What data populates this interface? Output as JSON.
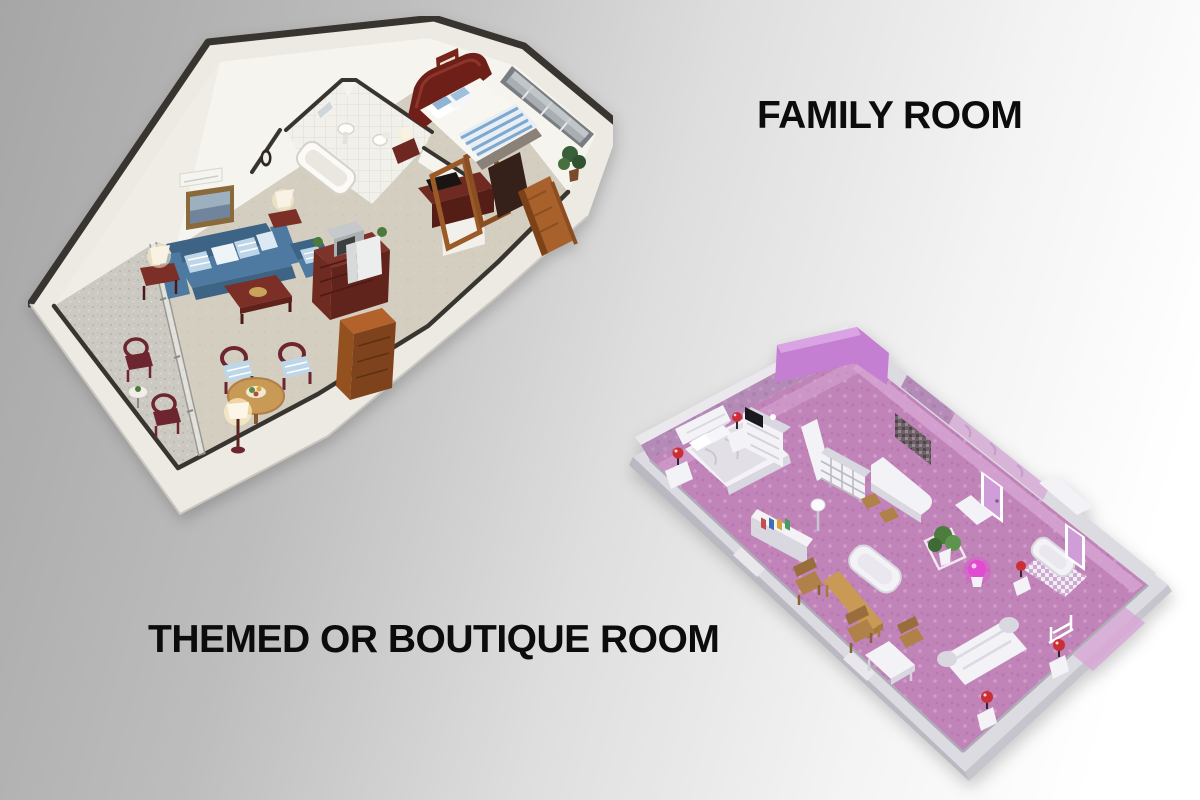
{
  "labels": {
    "family": "FAMILY ROOM",
    "themed": "THEMED OR BOUTIQUE ROOM"
  },
  "plans": {
    "family": {
      "icon": "family-room-floorplan",
      "rooms": [
        "balcony",
        "living-room",
        "dining-area",
        "bathroom",
        "bedroom",
        "entry-hall"
      ]
    },
    "themed": {
      "icon": "themed-or-boutique-room-floorplan",
      "rooms": [
        "bedroom",
        "kitchenette-bar",
        "lounge",
        "bathroom",
        "dressing-area"
      ]
    }
  },
  "palette": {
    "bg-left": "#a6a6a6",
    "bg-mid": "#dedede",
    "bg-right": "#ffffff",
    "ink": "#0c0c0c",
    "wall-dark": "#38342f",
    "wall-white": "#f6f4ee",
    "shell": "#eceae2",
    "carpet": "#d4cec0",
    "balcony-floor": "#ccc9c2",
    "tile": "#f0efe9",
    "sofa-blue": "#4e79a0",
    "sofa-blue-dark": "#3d6485",
    "pillow-blue": "#bdd7e9",
    "wood-red": "#7b2f27",
    "wood-maroon": "#6d2530",
    "wood-orange": "#b4622c",
    "wood-door": "#a9612c",
    "wood-tan": "#c89a56",
    "headboard-red": "#6e1f18",
    "bed-white": "#f7f6f1",
    "blanket-blue": "#7ca9cf",
    "window-gray": "#a9aeb2",
    "window-frame": "#787d81",
    "plant-green": "#39603a",
    "lamp-glow": "#ffefc4",
    "pink-floor": "#c184b8",
    "pink-floor-light": "#d8a8d6",
    "mauve-wall": "#b48ab6",
    "accent-purple": "#c47fd2",
    "accent-purple-light": "#daa3e4",
    "marble-pink": "#d7b4d8",
    "gray-wall": "#dddbe2",
    "gray-wall-dark": "#c3c1ca",
    "furn-white": "#f3f2f6",
    "furn-white-shade": "#d9d7df",
    "lilac-door": "#cf9ed8",
    "red-lamp": "#cb2f36",
    "magenta-lamp": "#e24ad2",
    "pink-wood": "#b08148"
  }
}
